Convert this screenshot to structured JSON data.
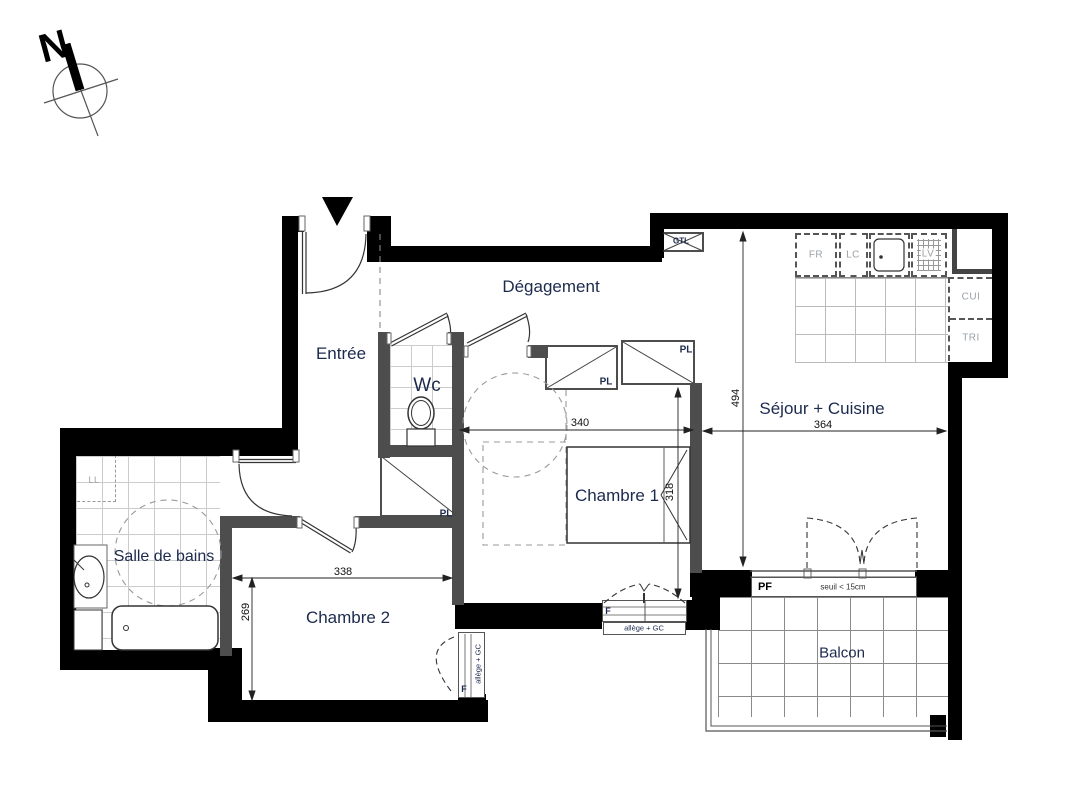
{
  "title": "Plan d'appartement 3 pièces",
  "compass": {
    "north_label": "N"
  },
  "rooms": {
    "entree": {
      "label": "Entrée"
    },
    "degagement": {
      "label": "Dégagement"
    },
    "wc": {
      "label": "Wc"
    },
    "chambre1": {
      "label": "Chambre 1"
    },
    "chambre2": {
      "label": "Chambre 2"
    },
    "salle_de_bains": {
      "label": "Salle de bains"
    },
    "sejour_cuisine": {
      "label": "Séjour + Cuisine"
    },
    "balcon": {
      "label": "Balcon"
    }
  },
  "dimensions_cm": {
    "sejour_depth": "494",
    "sejour_width": "364",
    "chambre1_width": "340",
    "chambre1_depth": "318",
    "chambre2_width": "338",
    "chambre2_depth": "269"
  },
  "annotations": {
    "gtl": "GTL",
    "fridge": "FR",
    "washer_column": "LC",
    "dishwasher": "LV",
    "kitchen_unit": "CUI",
    "bin": "TRI",
    "washing_machine": "LL",
    "closet": "PL",
    "french_window": "PF",
    "window": "F",
    "threshold_note": "seuil < 15cm",
    "sill_note": "allège + GC"
  },
  "colors": {
    "exterior_wall": "#000000",
    "interior_wall": "#4d4d4d",
    "room_label": "#1c2a4d",
    "appliance_label": "#9aa0a6",
    "linework": "#333333"
  }
}
